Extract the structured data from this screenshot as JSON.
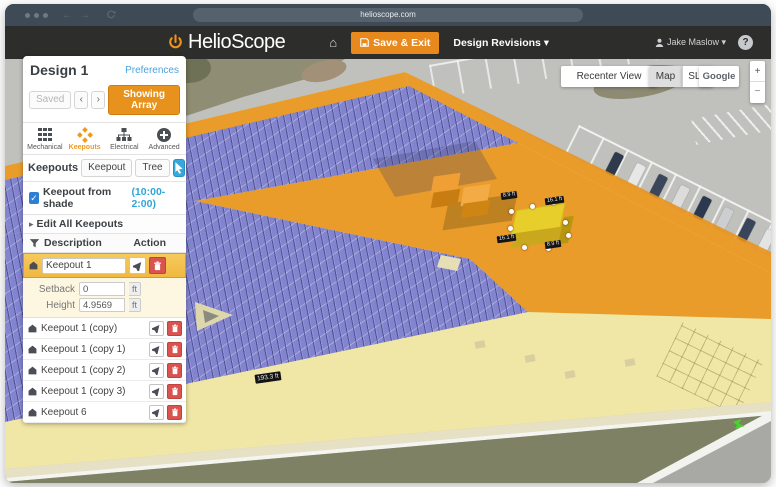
{
  "browser": {
    "url": "helioscope.com"
  },
  "header": {
    "logo_text": "HelioScope",
    "save_exit": "Save & Exit",
    "design_revisions": "Design Revisions ▾",
    "user": "Jake Maslow ▾",
    "help": "?"
  },
  "design": {
    "title": "Design 1",
    "preferences": "Preferences",
    "saved": "Saved",
    "prev": "‹",
    "next": "›",
    "showing_array": "Showing Array"
  },
  "tools": {
    "items": [
      {
        "label": "Mechanical"
      },
      {
        "label": "Keepouts"
      },
      {
        "label": "Electrical"
      },
      {
        "label": "Advanced"
      }
    ]
  },
  "keepouts": {
    "title": "Keepouts",
    "tab_keepout": "Keepout",
    "tab_tree": "Tree",
    "shade_label": "Keepout from shade",
    "shade_time": "(10:00-2:00)",
    "check_mark": "✓",
    "edit_all": "Edit All Keepouts",
    "desc_col": "Description",
    "action_col": "Action",
    "selected": {
      "name": "Keepout 1",
      "setback_label": "Setback",
      "setback_value": "0",
      "height_label": "Height",
      "height_value": "4.9569",
      "unit": "ft"
    },
    "rows": [
      {
        "name": "Keepout 1 (copy)"
      },
      {
        "name": "Keepout 1 (copy 1)"
      },
      {
        "name": "Keepout 1 (copy 2)"
      },
      {
        "name": "Keepout 1 (copy 3)"
      },
      {
        "name": "Keepout 6"
      }
    ]
  },
  "map": {
    "recenter": "Recenter View",
    "map_btn": "Map",
    "sld_btn": "SLD",
    "google_btn": "Google",
    "zoom_in": "+",
    "zoom_out": "−",
    "labels": {
      "edge": "193.3 ft",
      "d1": "8.9 ft",
      "d2": "16.1 ft",
      "d3": "16.1 ft",
      "d4": "8.9 ft"
    }
  },
  "colors": {
    "accent_orange": "#e8891d",
    "keepout_orange": "#e99119",
    "panel_purple": "#7d81d2",
    "link_blue": "#35a8dc",
    "delete_red": "#d9534f",
    "selected_yellow": "#f0b840"
  }
}
